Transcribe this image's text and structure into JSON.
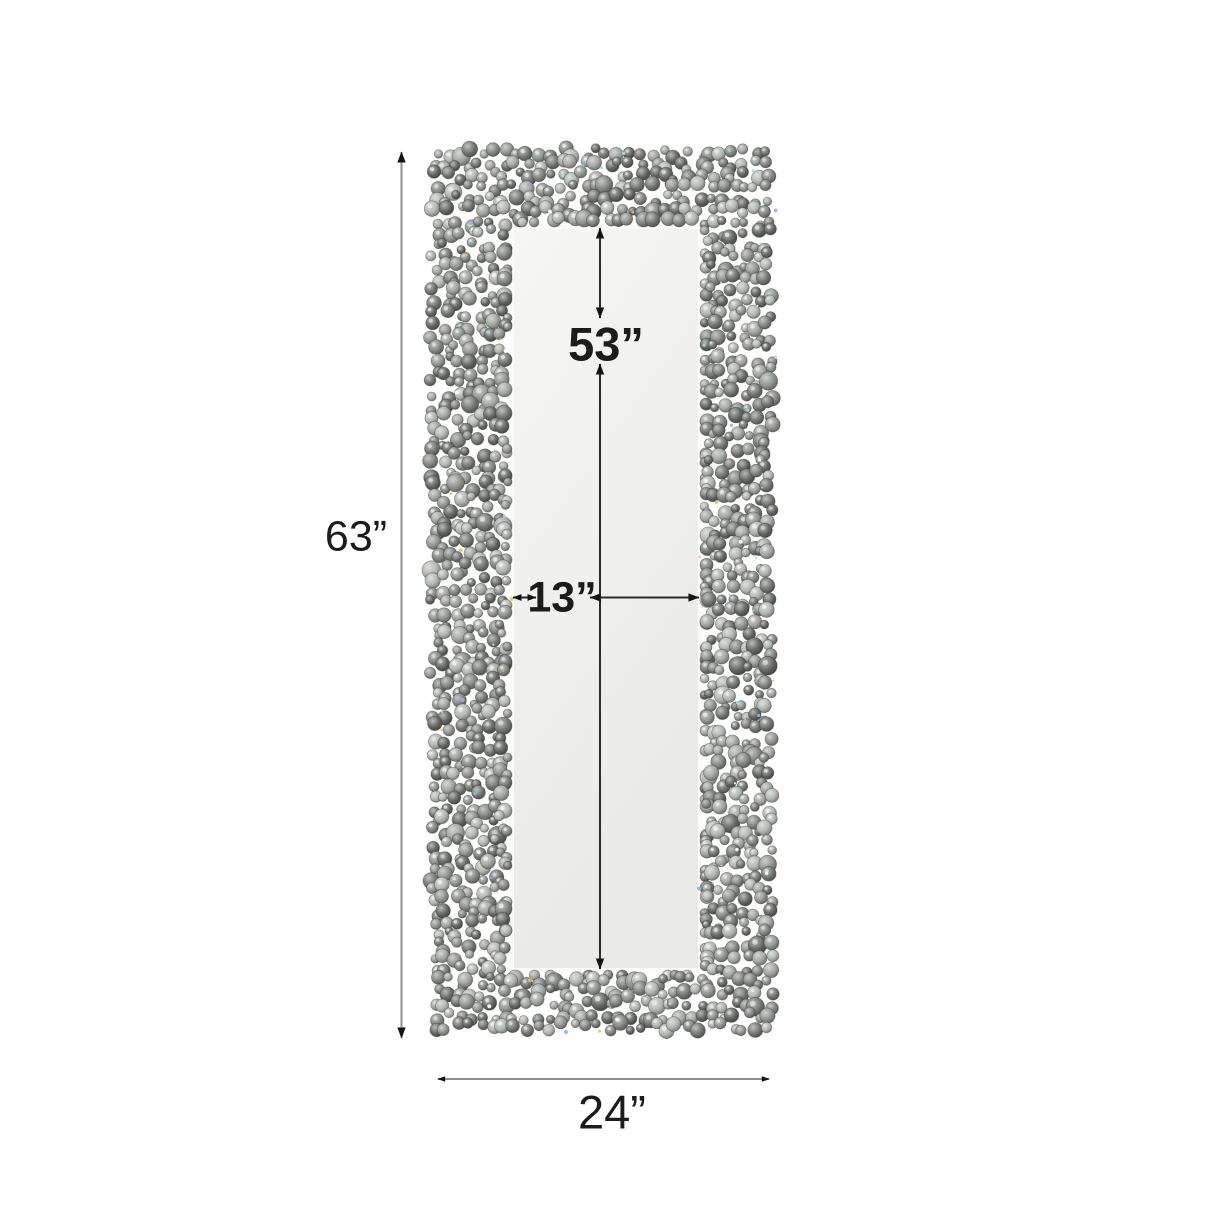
{
  "diagram": {
    "labels": {
      "overall_height": "63”",
      "overall_width": "24”",
      "mirror_height": "53”",
      "mirror_width": "13”"
    },
    "colors": {
      "background": "#ffffff",
      "text": "#1c1c1c",
      "outer_dim_line": "#8f8f8f",
      "inner_dim_line": "#2b2b2b",
      "arrowhead": "#141414",
      "mirror_bevel": "#fbfbf9",
      "mirror_glass_light": "#f6f6f4",
      "mirror_glass_dark": "#e9e9e7",
      "bead_palette": [
        "#a3a6a3",
        "#929692",
        "#838683",
        "#747774",
        "#646764",
        "#b3b7b3"
      ],
      "bead_stroke": "#3c403c",
      "bead_highlight": "#ffffff",
      "sparkle_colors": [
        "#8fb2e8",
        "#e8c06a",
        "#ffffff",
        "#a9dbe2"
      ]
    }
  }
}
